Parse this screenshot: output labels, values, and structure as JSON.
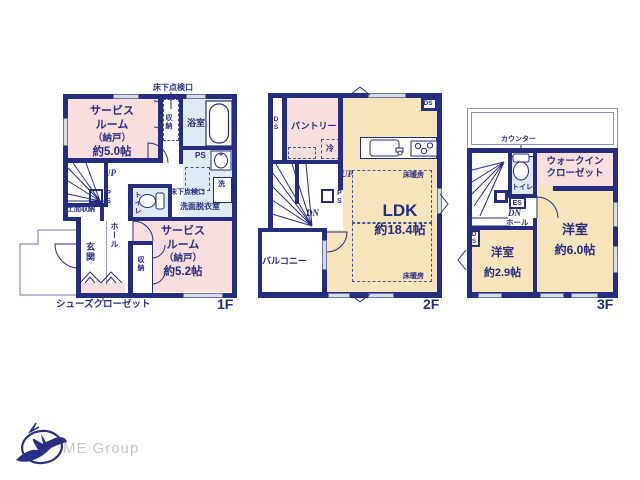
{
  "meta": {
    "type": "floor-plan",
    "company": "ME Group",
    "colors": {
      "wall_navy": "#262c7e",
      "room_pink": "#f9dede",
      "room_cream": "#f6e4bd",
      "wet_blue": "#dfeaf4",
      "window_gray": "#d7dbe6",
      "thin_line": "#8b90b8",
      "logo_text_gray": "#c6c6c6"
    }
  },
  "floor1": {
    "label": "1F",
    "inspection_hatch_top": "床下点検口",
    "service_room_a": {
      "l1": "サービス",
      "l2": "ルーム",
      "l3": "（納戸）",
      "l4": "約5.0帖"
    },
    "closet_a": "収納",
    "bathroom": "浴室",
    "ps_a": "PS",
    "inspection_hatch_wash": "床下点検口",
    "washer": "洗",
    "washroom": "洗面脱衣室",
    "toilet": "トイレ",
    "stairs_up": "UP",
    "ps_b": "PS",
    "doma_storage": "土間収納",
    "entrance": "玄関",
    "hall": "ホール",
    "closet_b": "収納",
    "service_room_b": {
      "l1": "サービス",
      "l2": "ルーム",
      "l3": "（納戸）",
      "l4": "約5.2帖"
    },
    "shoes_closet": "シューズクローゼット"
  },
  "floor2": {
    "label": "2F",
    "ds_left": "DS",
    "pantry": "パントリー",
    "fridge": "冷",
    "ds_right": "DS",
    "stairs_up": "UP",
    "ps": "PS",
    "stairs_down": "DN",
    "balcony": "バルコニー",
    "ldk": "LDK",
    "ldk_size": "約18.4帖",
    "floor_heating_a": "床暖房",
    "floor_heating_b": "床暖房"
  },
  "floor3": {
    "label": "3F",
    "counter": "カウンター",
    "toilet": "トイレ",
    "wic": {
      "l1": "ウォークイン",
      "l2": "クローゼット"
    },
    "es": "ES",
    "stairs_down": "DN",
    "hall": "ホール",
    "ds": "DS",
    "bedroom_a": {
      "name": "洋室",
      "size": "約2.9帖"
    },
    "bedroom_b": {
      "name": "洋室",
      "size": "約6.0帖"
    }
  },
  "logo": {
    "company": "ME Group"
  }
}
